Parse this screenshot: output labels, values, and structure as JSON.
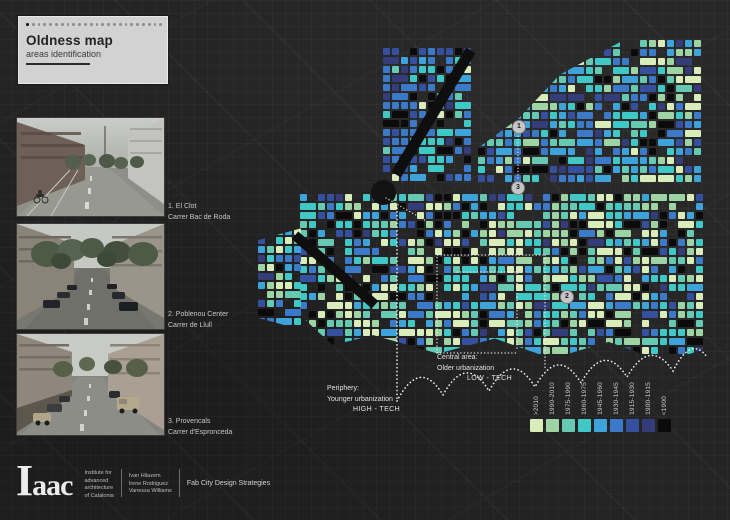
{
  "title_card": {
    "title": "Oldness map",
    "subtitle": "areas identification"
  },
  "photos": [
    {
      "id": "1",
      "caption_line1": "1. El Clot",
      "caption_line2": "Carrer Bac de Roda"
    },
    {
      "id": "2",
      "caption_line1": "2. Poblenou Center",
      "caption_line2": "Carrer de Llull"
    },
    {
      "id": "3",
      "caption_line1": "3. Provencals",
      "caption_line2": "Carrer d'Espronceda"
    }
  ],
  "map": {
    "markers": [
      {
        "label": "1"
      },
      {
        "label": "2"
      },
      {
        "label": "3"
      }
    ],
    "annotations": {
      "central": {
        "line1": "Central area:",
        "line2": "Older urbanization",
        "line3": "LOW - TECH"
      },
      "periphery": {
        "line1": "Periphery:",
        "line2": "Younger urbanization",
        "line3": "HIGH - TECH"
      }
    }
  },
  "legend": {
    "items": [
      {
        "label": ">2010",
        "color": "#d9edbb"
      },
      {
        "label": "1990-2010",
        "color": "#9ed4a4"
      },
      {
        "label": "1975-1990",
        "color": "#66c9b1"
      },
      {
        "label": "1960-1975",
        "color": "#3fc8c6"
      },
      {
        "label": "1945-1960",
        "color": "#3da3da"
      },
      {
        "label": "1930-1945",
        "color": "#3b7ac9"
      },
      {
        "label": "1915-1930",
        "color": "#35509e"
      },
      {
        "label": "1900-1915",
        "color": "#343c79"
      },
      {
        "label": "<1900",
        "color": "#0b0b0b"
      }
    ]
  },
  "footer": {
    "logo": "Iaac",
    "institute_lines": [
      "Institute for",
      "advanced",
      "architecture",
      "of Catalonia"
    ],
    "authors": [
      "Ivan Hilazem",
      "Irene Rodriguez",
      "Vanessa Williams"
    ],
    "program": "Fab City Design Strategies"
  }
}
